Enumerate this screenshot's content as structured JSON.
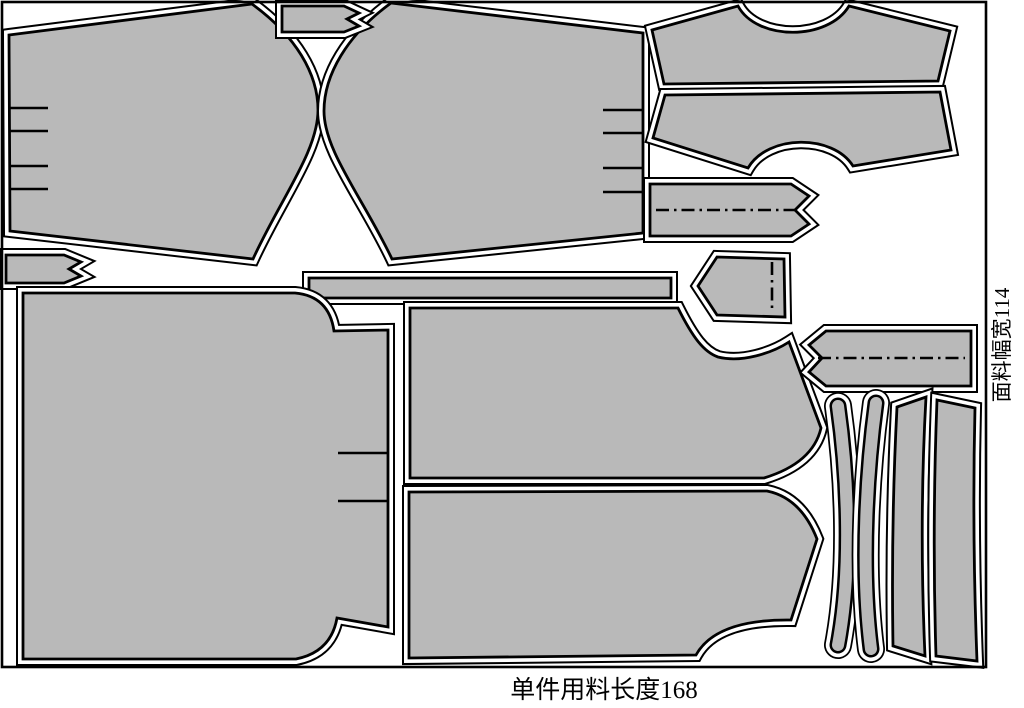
{
  "diagram": {
    "type": "garment-marker-layout",
    "labels": {
      "fabric_width": "面料幅宽114",
      "piece_length": "单件用料长度168"
    },
    "colors": {
      "background": "#ffffff",
      "piece_fill": "#b9b9b9",
      "outline": "#000000"
    },
    "piece_count": 16,
    "pieces": [
      {
        "id": "piece-large-top-left",
        "features": "s-curved right edge, 4 notch marks on left edge"
      },
      {
        "id": "piece-large-top-center",
        "features": "s-curved left edge, 4 notch marks on right edge"
      },
      {
        "id": "piece-small-tab-top",
        "features": "notched right end"
      },
      {
        "id": "piece-small-tab-left",
        "features": "notched right end"
      },
      {
        "id": "piece-yoke-upper-right",
        "features": "neck scoop on top edge"
      },
      {
        "id": "piece-yoke-lower-right",
        "features": "neck scoop on bottom edge"
      },
      {
        "id": "piece-band-dashdot-1",
        "features": "horizontal dash-dot fold line, notched right end"
      },
      {
        "id": "piece-pentagon-tab",
        "features": "vertical dash-dot fold line, pointed left end"
      },
      {
        "id": "piece-long-thin-strip",
        "features": "plain rectangle strip"
      },
      {
        "id": "piece-large-panel-left",
        "features": "stepped rounded right corners, 2 notch marks on right edge"
      },
      {
        "id": "piece-panel-middle-upper",
        "features": "scoop and angled tab on right side"
      },
      {
        "id": "piece-panel-middle-lower",
        "features": "angled tab on right side"
      },
      {
        "id": "piece-band-dashdot-2",
        "features": "horizontal dash-dot fold line, notched left end"
      },
      {
        "id": "piece-curved-sliver-1",
        "features": "narrow crescent strip bowing right"
      },
      {
        "id": "piece-curved-sliver-2",
        "features": "narrow crescent strip bowing left"
      },
      {
        "id": "piece-narrow-strip-1",
        "features": "tall waisted strip, slanted ends"
      },
      {
        "id": "piece-narrow-strip-2",
        "features": "tall waisted strip, slanted ends"
      }
    ]
  }
}
